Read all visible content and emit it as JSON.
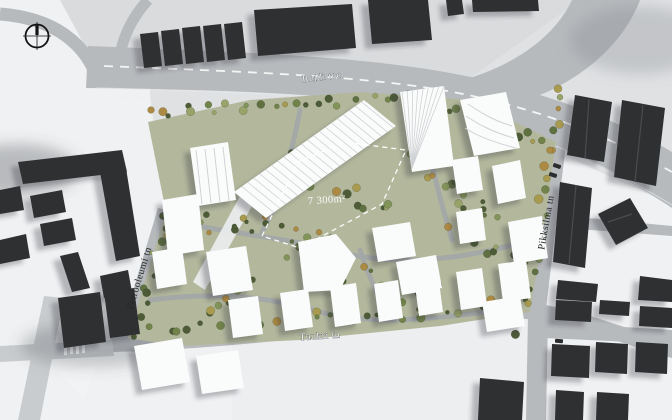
{
  "compass": {
    "icon": "compass-crosshair-icon"
  },
  "streets": {
    "reidi": {
      "name": "Reidi tee"
    },
    "petrooleumi": {
      "name": "Petrooleumi tn"
    },
    "tuukri": {
      "name": "Tuukri tn"
    },
    "pikksilma": {
      "name": "Pikksilma tn"
    }
  },
  "site": {
    "area_label": "7 300m²"
  },
  "colors": {
    "background": "#dfe1e3",
    "ground_light": "#f0f1f2",
    "ground_mid": "#eceef0",
    "top_strip": "#d9dbdd",
    "road": "#b7babd",
    "road_light": "#c9ccce",
    "lane_marking": "#ffffff",
    "site_ground": "#b3b89d",
    "path": "#a2a6a9",
    "tree_palette": [
      "#4d5c37",
      "#5f7041",
      "#71834b",
      "#83945a",
      "#97a368",
      "#a89a4e",
      "#ad8a43"
    ],
    "building_white": "#fafbfb",
    "building_white_detail": "#cfd2d4",
    "building_dark": "#2e3032",
    "building_dark_ridge": "#4a4d50",
    "shadow": "rgba(45,50,56,0.30)",
    "dashed_outline": "#ffffff",
    "label_light": "#f3f4f5",
    "label_dark": "#26282a",
    "car": "#2a2c2e"
  }
}
